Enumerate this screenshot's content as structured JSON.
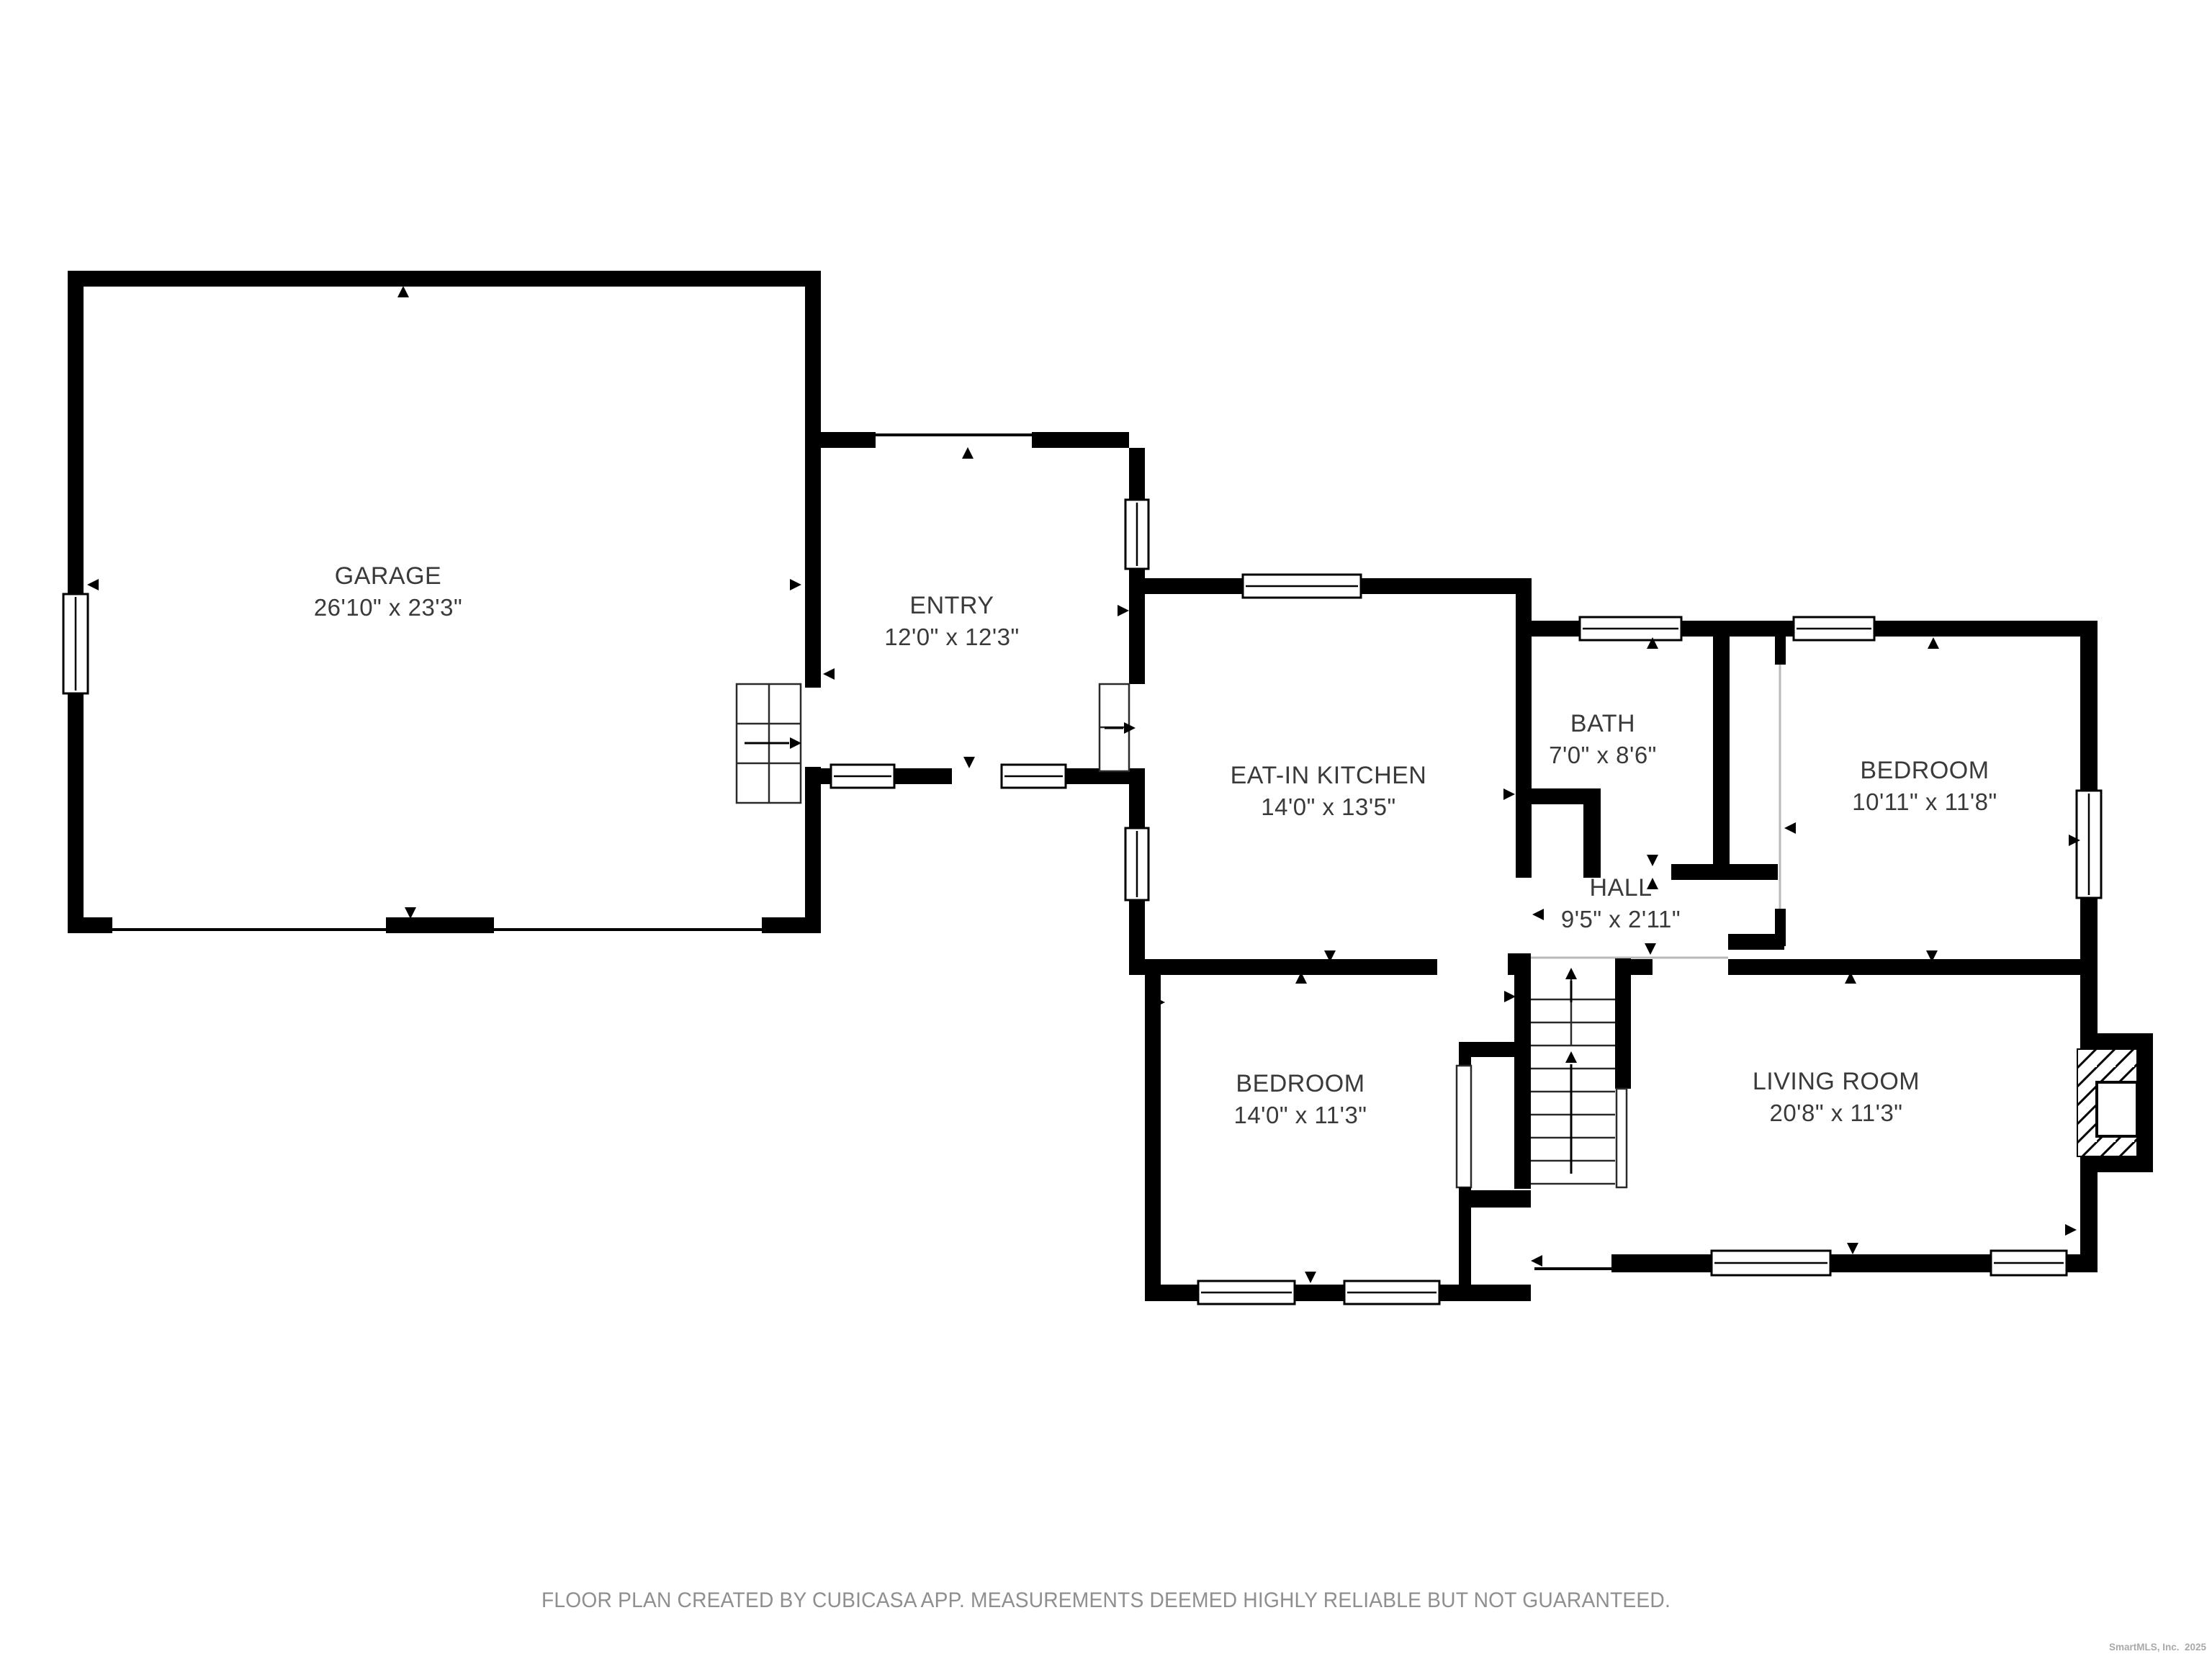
{
  "plan": {
    "rooms": [
      {
        "id": "garage",
        "name": "GARAGE",
        "dims": "26'10\" x 23'3\""
      },
      {
        "id": "entry",
        "name": "ENTRY",
        "dims": "12'0\" x 12'3\""
      },
      {
        "id": "eat-in-kitchen",
        "name": "EAT-IN KITCHEN",
        "dims": "14'0\" x 13'5\""
      },
      {
        "id": "bath",
        "name": "BATH",
        "dims": "7'0\" x 8'6\""
      },
      {
        "id": "bedroom-upper",
        "name": "BEDROOM",
        "dims": "10'11\" x 11'8\""
      },
      {
        "id": "hall",
        "name": "HALL",
        "dims": "9'5\" x 2'11\""
      },
      {
        "id": "bedroom-lower",
        "name": "BEDROOM",
        "dims": "14'0\" x 11'3\""
      },
      {
        "id": "living-room",
        "name": "LIVING ROOM",
        "dims": "20'8\" x 11'3\""
      }
    ],
    "footer": "FLOOR PLAN CREATED BY CUBICASA APP. MEASUREMENTS DEEMED HIGHLY RELIABLE BUT NOT GUARANTEED.",
    "watermark": "SmartMLS, Inc.  2025",
    "colors": {
      "wall": "#000000",
      "label": "#3a3a3a",
      "footer": "#8f8f8f",
      "watermark": "#a9a9a9",
      "background": "#ffffff"
    }
  }
}
